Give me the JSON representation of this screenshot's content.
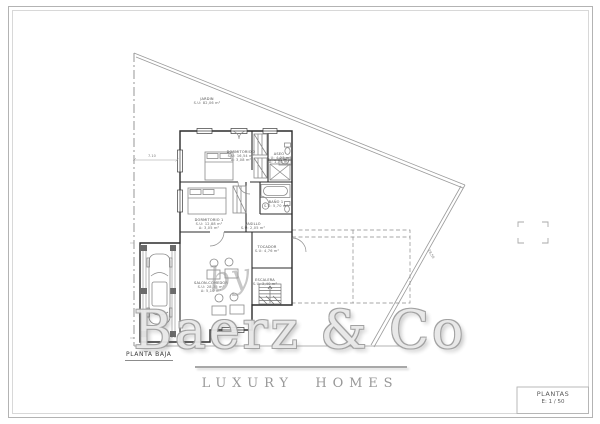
{
  "drawing": {
    "plan_label": "PLANTA BAJA",
    "title_block": {
      "title": "PLANTAS",
      "scale": "E: 1 / 50"
    }
  },
  "watermark": {
    "by": "by",
    "brand": "Baerz & Co",
    "tagline": "LUXURY HOMES"
  },
  "rooms": [
    {
      "name": "JARDIN",
      "area": "S.U: 82,06 m²"
    },
    {
      "name": "DORMITORIO 2",
      "area": "S.U: 16,54 m²",
      "extra": "A: 3,08 m²"
    },
    {
      "name": "ASEO",
      "area": "S.U: 4,23 m²",
      "extra": "A: 1,70 m²"
    },
    {
      "name": "BAÑO 1",
      "area": "S.U: 5,70 m²"
    },
    {
      "name": "DORMITORIO 1",
      "area": "S.U: 12,88 m²",
      "extra": "A: 3,05 m²"
    },
    {
      "name": "PASILLO",
      "area": "S.U: 2,05 m²"
    },
    {
      "name": "TOCADOR",
      "area": "S.U: 4,76 m²"
    },
    {
      "name": "ESCALERA",
      "area": "S.U: 3,40 m²"
    },
    {
      "name": "SALON-COMEDOR",
      "area": "S.U: 28,35 m²",
      "extra": "A: 5,10 m²"
    }
  ],
  "dimensions": {
    "jardin_width": "7.10",
    "boundary_length": "28,50"
  },
  "colors": {
    "wall": "#2b2b2b",
    "fixture": "#888888",
    "boundary": "#999999",
    "watermark": "#9e9e9e"
  }
}
